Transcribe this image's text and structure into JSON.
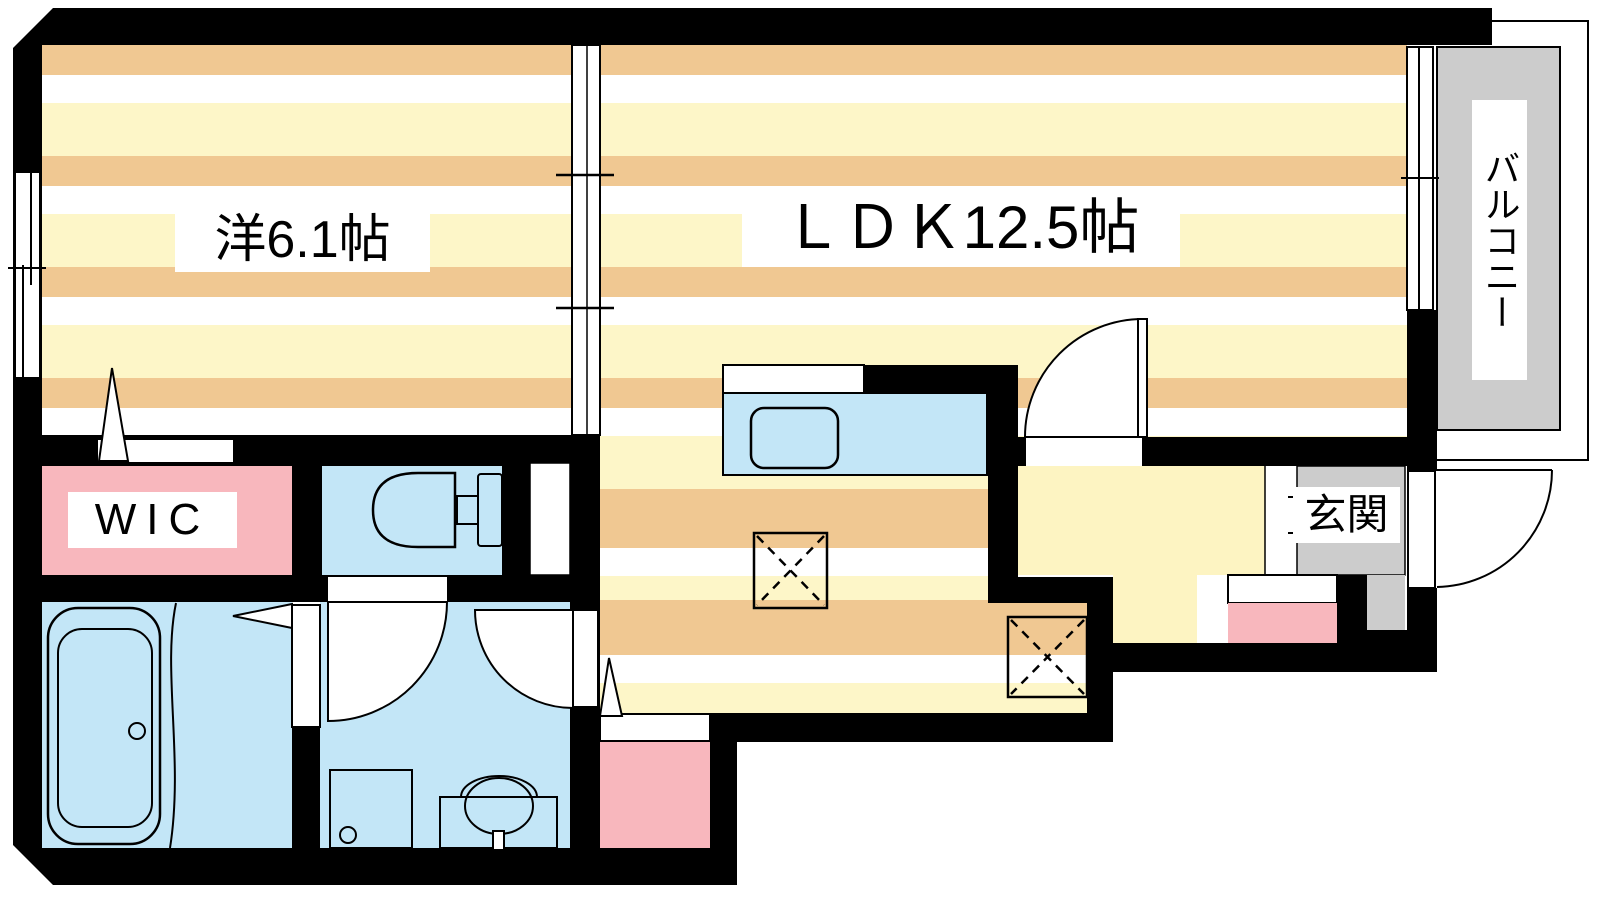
{
  "floorplan": {
    "type": "apartment-floor-plan",
    "rooms": {
      "western_room": {
        "label": "洋6.1帖"
      },
      "ldk": {
        "label": "ＬＤＫ12.5帖"
      },
      "wic": {
        "label": "WIC"
      },
      "entrance": {
        "label": "玄関"
      },
      "balcony": {
        "label": "バルコニー"
      }
    },
    "colors": {
      "wall": "#000000",
      "line": "#000000",
      "white": "#ffffff",
      "stripe_tan": "#f0c892",
      "stripe_white": "#ffffff",
      "stripe_yellow": "#fdf6c8",
      "hall_yellow": "#fdf4c2",
      "water_blue": "#c3e6f7",
      "pink": "#f8b7bd",
      "gray": "#cccccc"
    }
  }
}
